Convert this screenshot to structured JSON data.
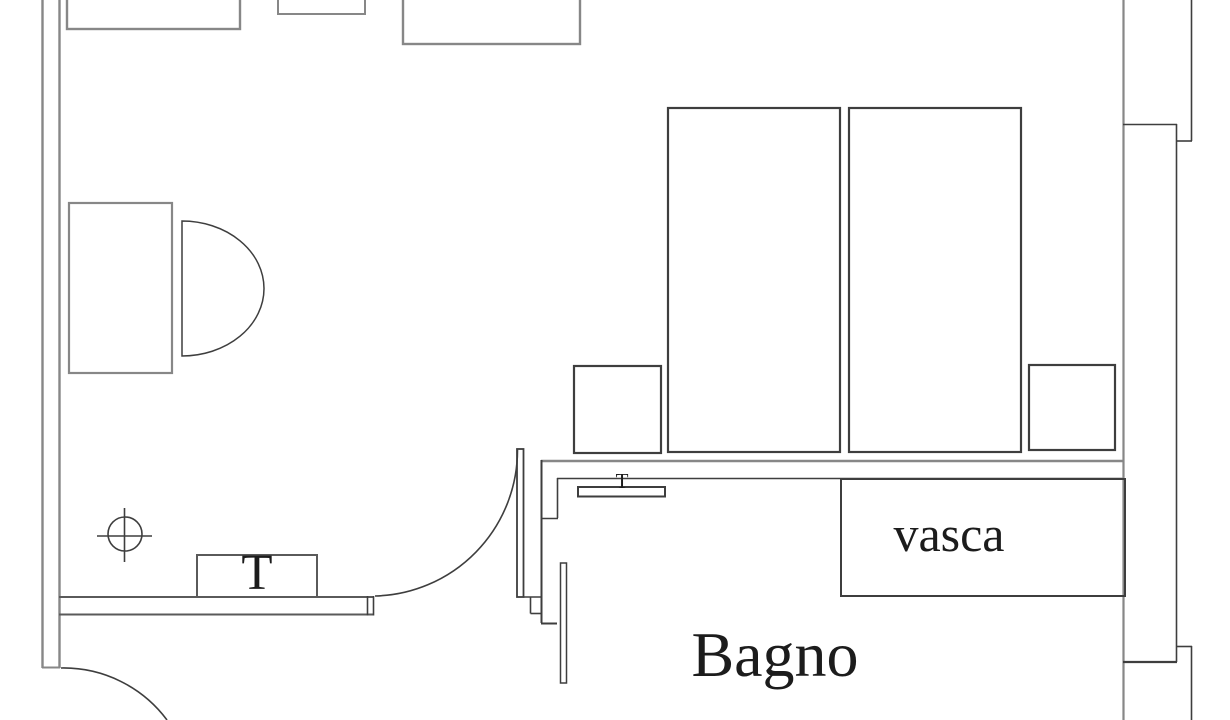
{
  "plan": {
    "type": "floor-plan",
    "room_labels": {
      "bathroom": "Bagno",
      "bathtub": "vasca"
    },
    "fixture_labels": {
      "tv_table": "T",
      "bathroom_shelf": "T"
    },
    "colors": {
      "bg": "#ffffff",
      "wall-gray": "#878787",
      "line-mid": "#5a5a5a",
      "line-dark": "#3e3e3e",
      "text": "#1c1c1c"
    }
  }
}
